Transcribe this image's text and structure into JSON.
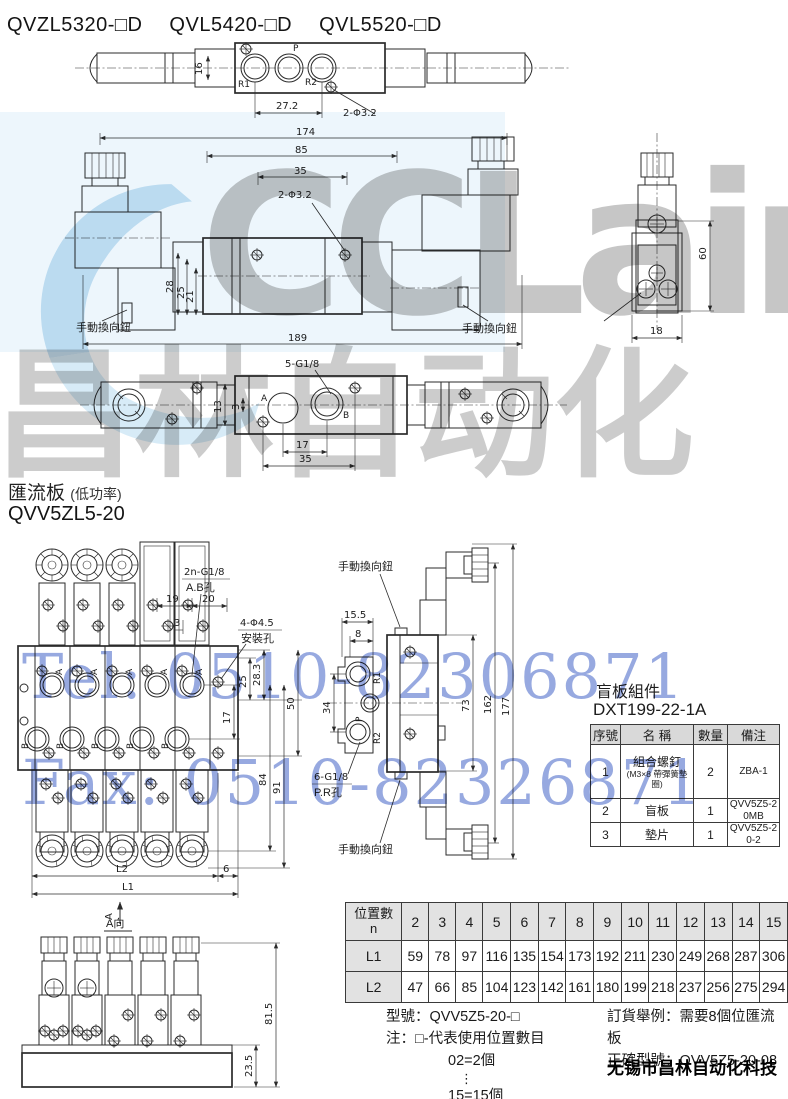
{
  "header": {
    "models": [
      "QVZL5320-□D",
      "QVL5420-□D",
      "QVL5520-□D"
    ]
  },
  "watermark": {
    "brand": "CCLair",
    "brand_cn": "昌林自动化",
    "tel": "Tel: 0510-82306871",
    "fax": "Fax: 0510-82326871",
    "brand_color": "#979797",
    "contact_color": "#7d94d8",
    "swoosh_color": "#bcdcf0"
  },
  "top_view": {
    "dim_16": "16",
    "dim_272": "27.2",
    "dim_holes": "2-Φ3.2",
    "port_r1": "R1",
    "port_p": "P",
    "port_r2": "R2"
  },
  "front_view": {
    "dim_174": "174",
    "dim_85": "85",
    "dim_35": "35",
    "dim_holes": "2-Φ3.2",
    "dim_28": "28",
    "dim_25": "25",
    "dim_21": "21",
    "dim_189": "189",
    "knob_left": "手動換向鈕",
    "knob_right": "手動換向鈕"
  },
  "end_view": {
    "dim_60": "60",
    "dim_18": "18"
  },
  "bottom_view": {
    "label_ports": "5-G1/8",
    "dim_13": "13",
    "dim_3": "3",
    "dim_17": "17",
    "dim_35": "35",
    "port_a": "A",
    "port_b": "B"
  },
  "section": {
    "title": "匯流板",
    "subtitle": "(低功率)",
    "model": "QVV5ZL5-20"
  },
  "manifold_view": {
    "label_ab": "2n-G1/8",
    "label_ab2": "A.B孔",
    "dim_19": "19",
    "dim_20": "20",
    "dim_3": "3",
    "label_mount": "4-Φ4.5",
    "label_mount2": "安裝孔",
    "dim_17": "17",
    "dim_25": "25",
    "dim_283": "28.3",
    "dim_50": "50",
    "dim_84": "84",
    "dim_91": "91",
    "dim_L2": "L2",
    "dim_6": "6",
    "dim_L1": "L1",
    "arrow": "A",
    "port_a": "A",
    "port_b": "B"
  },
  "side_view": {
    "knob_top": "手動換向鈕",
    "knob_bottom": "手動換向鈕",
    "dim_155": "15.5",
    "dim_8": "8",
    "dim_34": "34",
    "dim_73": "73",
    "dim_162": "162",
    "dim_177": "177",
    "port_r1": "R1",
    "port_p": "P",
    "port_r2": "R2",
    "label_pr": "6-G1/8",
    "label_pr2": "P.R孔"
  },
  "aview": {
    "label": "A向",
    "dim_815": "81.5",
    "dim_235": "23.5"
  },
  "blind_plate": {
    "title": "盲板組件",
    "model": "DXT199-22-1A",
    "headers": [
      "序號",
      "名 稱",
      "數量",
      "備注"
    ],
    "rows": [
      {
        "no": "1",
        "name": "組合螺釘",
        "sub": "(M3×8 帶彈簧墊圈)",
        "qty": "2",
        "note": "ZBA-1"
      },
      {
        "no": "2",
        "name": "盲板",
        "sub": "",
        "qty": "1",
        "note": "QVV5Z5-20MB"
      },
      {
        "no": "3",
        "name": "墊片",
        "sub": "",
        "qty": "1",
        "note": "QVV5Z5-20-2"
      }
    ]
  },
  "position_table": {
    "corner_top": "位置數",
    "corner_bottom": "n",
    "n": [
      "2",
      "3",
      "4",
      "5",
      "6",
      "7",
      "8",
      "9",
      "10",
      "11",
      "12",
      "13",
      "14",
      "15"
    ],
    "rows": [
      {
        "label": "L1",
        "values": [
          "59",
          "78",
          "97",
          "116",
          "135",
          "154",
          "173",
          "192",
          "211",
          "230",
          "249",
          "268",
          "287",
          "306"
        ]
      },
      {
        "label": "L2",
        "values": [
          "47",
          "66",
          "85",
          "104",
          "123",
          "142",
          "161",
          "180",
          "199",
          "218",
          "237",
          "256",
          "275",
          "294"
        ]
      }
    ]
  },
  "ordering": {
    "model_line": "型號：QVV5Z5-20-□",
    "note_line": "注：□-代表使用位置數目",
    "eg_first": "02=2個",
    "dots": "⋮",
    "eg_last": "15=15個",
    "order_example": "訂貨舉例：需要8個位匯流板",
    "order_model": "正確型號：QVV5Z5-20-08"
  },
  "footer": {
    "company": "无锡市昌林自动化科技"
  }
}
